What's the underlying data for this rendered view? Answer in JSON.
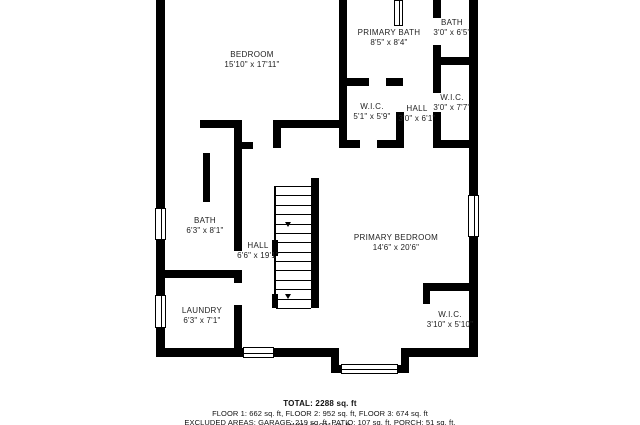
{
  "colors": {
    "wall": "#000000",
    "text": "#222222",
    "background": "#ffffff"
  },
  "footer": {
    "total": "TOTAL: 2288 sq. ft",
    "floors": "FLOOR 1: 662 sq. ft, FLOOR 2: 952 sq. ft, FLOOR 3: 674 sq. ft",
    "excluded": "EXCLUDED AREAS: GARAGE: 219 sq. ft, PATIO: 107 sq. ft, PORCH: 51 sq. ft,",
    "clipped_line": "WALLS: 231 sq. ft"
  },
  "rooms": [
    {
      "id": "bedroom",
      "name": "BEDROOM",
      "dims": "15'10\" x 17'11\"",
      "cx": 252,
      "cy": 60
    },
    {
      "id": "primary-bath",
      "name": "PRIMARY BATH",
      "dims": "8'5\" x 8'4\"",
      "cx": 389,
      "cy": 38
    },
    {
      "id": "bath-upper",
      "name": "BATH",
      "dims": "3'0\" x 6'5\"",
      "cx": 452,
      "cy": 28
    },
    {
      "id": "wic-primary",
      "name": "W.I.C.",
      "dims": "5'1\" x 5'9\"",
      "cx": 372,
      "cy": 112
    },
    {
      "id": "hall-upper",
      "name": "HALL",
      "dims": "3'0\" x 6'1\"",
      "cx": 417,
      "cy": 114
    },
    {
      "id": "wic-right",
      "name": "W.I.C.",
      "dims": "3'0\" x 7'7\"",
      "cx": 452,
      "cy": 103
    },
    {
      "id": "bath-left",
      "name": "BATH",
      "dims": "6'3\" x 8'1\"",
      "cx": 205,
      "cy": 226
    },
    {
      "id": "hall-main",
      "name": "HALL",
      "dims": "6'6\" x 19'1\"",
      "cx": 258,
      "cy": 251
    },
    {
      "id": "primary-bedroom",
      "name": "PRIMARY BEDROOM",
      "dims": "14'6\" x 20'6\"",
      "cx": 396,
      "cy": 243
    },
    {
      "id": "laundry",
      "name": "LAUNDRY",
      "dims": "6'3\" x 7'1\"",
      "cx": 202,
      "cy": 316
    },
    {
      "id": "wic-lower",
      "name": "W.I.C.",
      "dims": "3'10\" x 5'10\"",
      "cx": 450,
      "cy": 320
    }
  ],
  "walls": [
    {
      "x": 156,
      "y": 0,
      "w": 9,
      "h": 357
    },
    {
      "x": 469,
      "y": 0,
      "w": 9,
      "h": 357
    },
    {
      "x": 156,
      "y": 348,
      "w": 183,
      "h": 9
    },
    {
      "x": 401,
      "y": 348,
      "w": 77,
      "h": 9
    },
    {
      "x": 331,
      "y": 348,
      "w": 8,
      "h": 24
    },
    {
      "x": 401,
      "y": 348,
      "w": 8,
      "h": 24
    },
    {
      "x": 331,
      "y": 365,
      "w": 78,
      "h": 8
    },
    {
      "x": 339,
      "y": 0,
      "w": 8,
      "h": 147
    },
    {
      "x": 343,
      "y": 78,
      "w": 26,
      "h": 8
    },
    {
      "x": 386,
      "y": 78,
      "w": 17,
      "h": 8
    },
    {
      "x": 433,
      "y": 0,
      "w": 8,
      "h": 18
    },
    {
      "x": 433,
      "y": 45,
      "w": 8,
      "h": 48
    },
    {
      "x": 433,
      "y": 112,
      "w": 8,
      "h": 35
    },
    {
      "x": 438,
      "y": 57,
      "w": 32,
      "h": 8
    },
    {
      "x": 339,
      "y": 140,
      "w": 21,
      "h": 8
    },
    {
      "x": 377,
      "y": 140,
      "w": 26,
      "h": 8
    },
    {
      "x": 433,
      "y": 140,
      "w": 40,
      "h": 8
    },
    {
      "x": 396,
      "y": 112,
      "w": 8,
      "h": 36
    },
    {
      "x": 273,
      "y": 120,
      "w": 73,
      "h": 8
    },
    {
      "x": 273,
      "y": 120,
      "w": 8,
      "h": 28
    },
    {
      "x": 200,
      "y": 120,
      "w": 41,
      "h": 8
    },
    {
      "x": 234,
      "y": 120,
      "w": 8,
      "h": 131
    },
    {
      "x": 241,
      "y": 142,
      "w": 12,
      "h": 7
    },
    {
      "x": 203,
      "y": 153,
      "w": 7,
      "h": 49
    },
    {
      "x": 164,
      "y": 270,
      "w": 77,
      "h": 8
    },
    {
      "x": 234,
      "y": 270,
      "w": 8,
      "h": 13
    },
    {
      "x": 234,
      "y": 305,
      "w": 8,
      "h": 47
    },
    {
      "x": 311,
      "y": 178,
      "w": 8,
      "h": 130
    },
    {
      "x": 423,
      "y": 283,
      "w": 47,
      "h": 8
    },
    {
      "x": 423,
      "y": 283,
      "w": 7,
      "h": 21
    }
  ],
  "windows": [
    {
      "x": 155,
      "y": 208,
      "w": 11,
      "h": 32,
      "o": "v"
    },
    {
      "x": 155,
      "y": 295,
      "w": 11,
      "h": 33,
      "o": "v"
    },
    {
      "x": 468,
      "y": 195,
      "w": 11,
      "h": 42,
      "o": "v"
    },
    {
      "x": 243,
      "y": 347,
      "w": 31,
      "h": 11,
      "o": "h"
    },
    {
      "x": 341,
      "y": 364,
      "w": 57,
      "h": 10,
      "o": "h"
    },
    {
      "x": 394,
      "y": 0,
      "w": 9,
      "h": 26,
      "o": "v"
    }
  ],
  "stairs": {
    "rail": {
      "x": 274,
      "y": 186,
      "w": 2,
      "h": 122
    },
    "treads": {
      "x": 276,
      "y": 186,
      "w": 35,
      "h": 122,
      "count": 13
    },
    "blocks": [
      {
        "x": 272,
        "y": 240,
        "w": 6,
        "h": 16
      },
      {
        "x": 272,
        "y": 294,
        "w": 6,
        "h": 14
      }
    ],
    "arrows": [
      {
        "x": 285,
        "y": 222
      },
      {
        "x": 285,
        "y": 294
      }
    ]
  }
}
